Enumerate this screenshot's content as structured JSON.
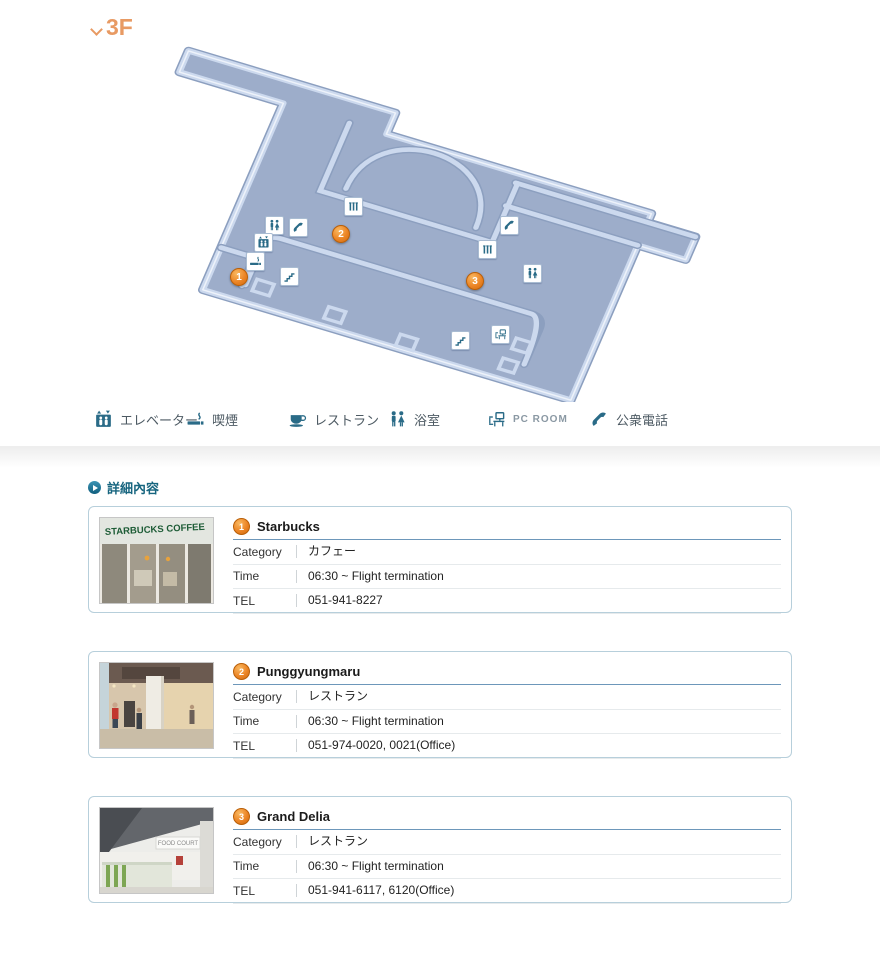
{
  "floor": {
    "label": "3F"
  },
  "map": {
    "markers": [
      {
        "label": "1"
      },
      {
        "label": "2"
      },
      {
        "label": "3"
      }
    ]
  },
  "legend": {
    "items": [
      {
        "icon": "elevator-icon",
        "label": "エレベーター"
      },
      {
        "icon": "smoking-icon",
        "label": "喫煙"
      },
      {
        "icon": "restaurant-icon",
        "label": "レストラン"
      },
      {
        "icon": "bath-icon",
        "label": "浴室"
      },
      {
        "icon": "pcroom-icon",
        "label": "PC ROOM"
      },
      {
        "icon": "phone-icon",
        "label": "公衆電話"
      }
    ]
  },
  "section": {
    "title": "詳細內容"
  },
  "cards": [
    {
      "num": "1",
      "name": "Starbucks",
      "photo_sign": "STARBUCKS COFFEE",
      "rows": [
        {
          "label": "Category",
          "value": "カフェー"
        },
        {
          "label": "Time",
          "value": "06:30 ~ Flight termination"
        },
        {
          "label": "TEL",
          "value": "051-941-8227"
        }
      ]
    },
    {
      "num": "2",
      "name": "Punggyungmaru",
      "rows": [
        {
          "label": "Category",
          "value": "レストラン"
        },
        {
          "label": "Time",
          "value": "06:30 ~ Flight termination"
        },
        {
          "label": "TEL",
          "value": "051-974-0020, 0021(Office)"
        }
      ]
    },
    {
      "num": "3",
      "name": "Grand Delia",
      "photo_sign": "FOOD COURT",
      "rows": [
        {
          "label": "Category",
          "value": "レストラン"
        },
        {
          "label": "Time",
          "value": "06:30 ~ Flight termination"
        },
        {
          "label": "TEL",
          "value": "051-941-6117, 6120(Office)"
        }
      ]
    }
  ],
  "colors": {
    "floor_title_orange": "#e89a63",
    "marker_orange": "#ec8526",
    "icon_teal": "#2a6b87",
    "section_teal": "#17657f",
    "map_floor": "#9dadca",
    "map_wall": "#ccd9ee",
    "card_border": "#b7cfdb",
    "title_underline": "#6d97ba"
  }
}
